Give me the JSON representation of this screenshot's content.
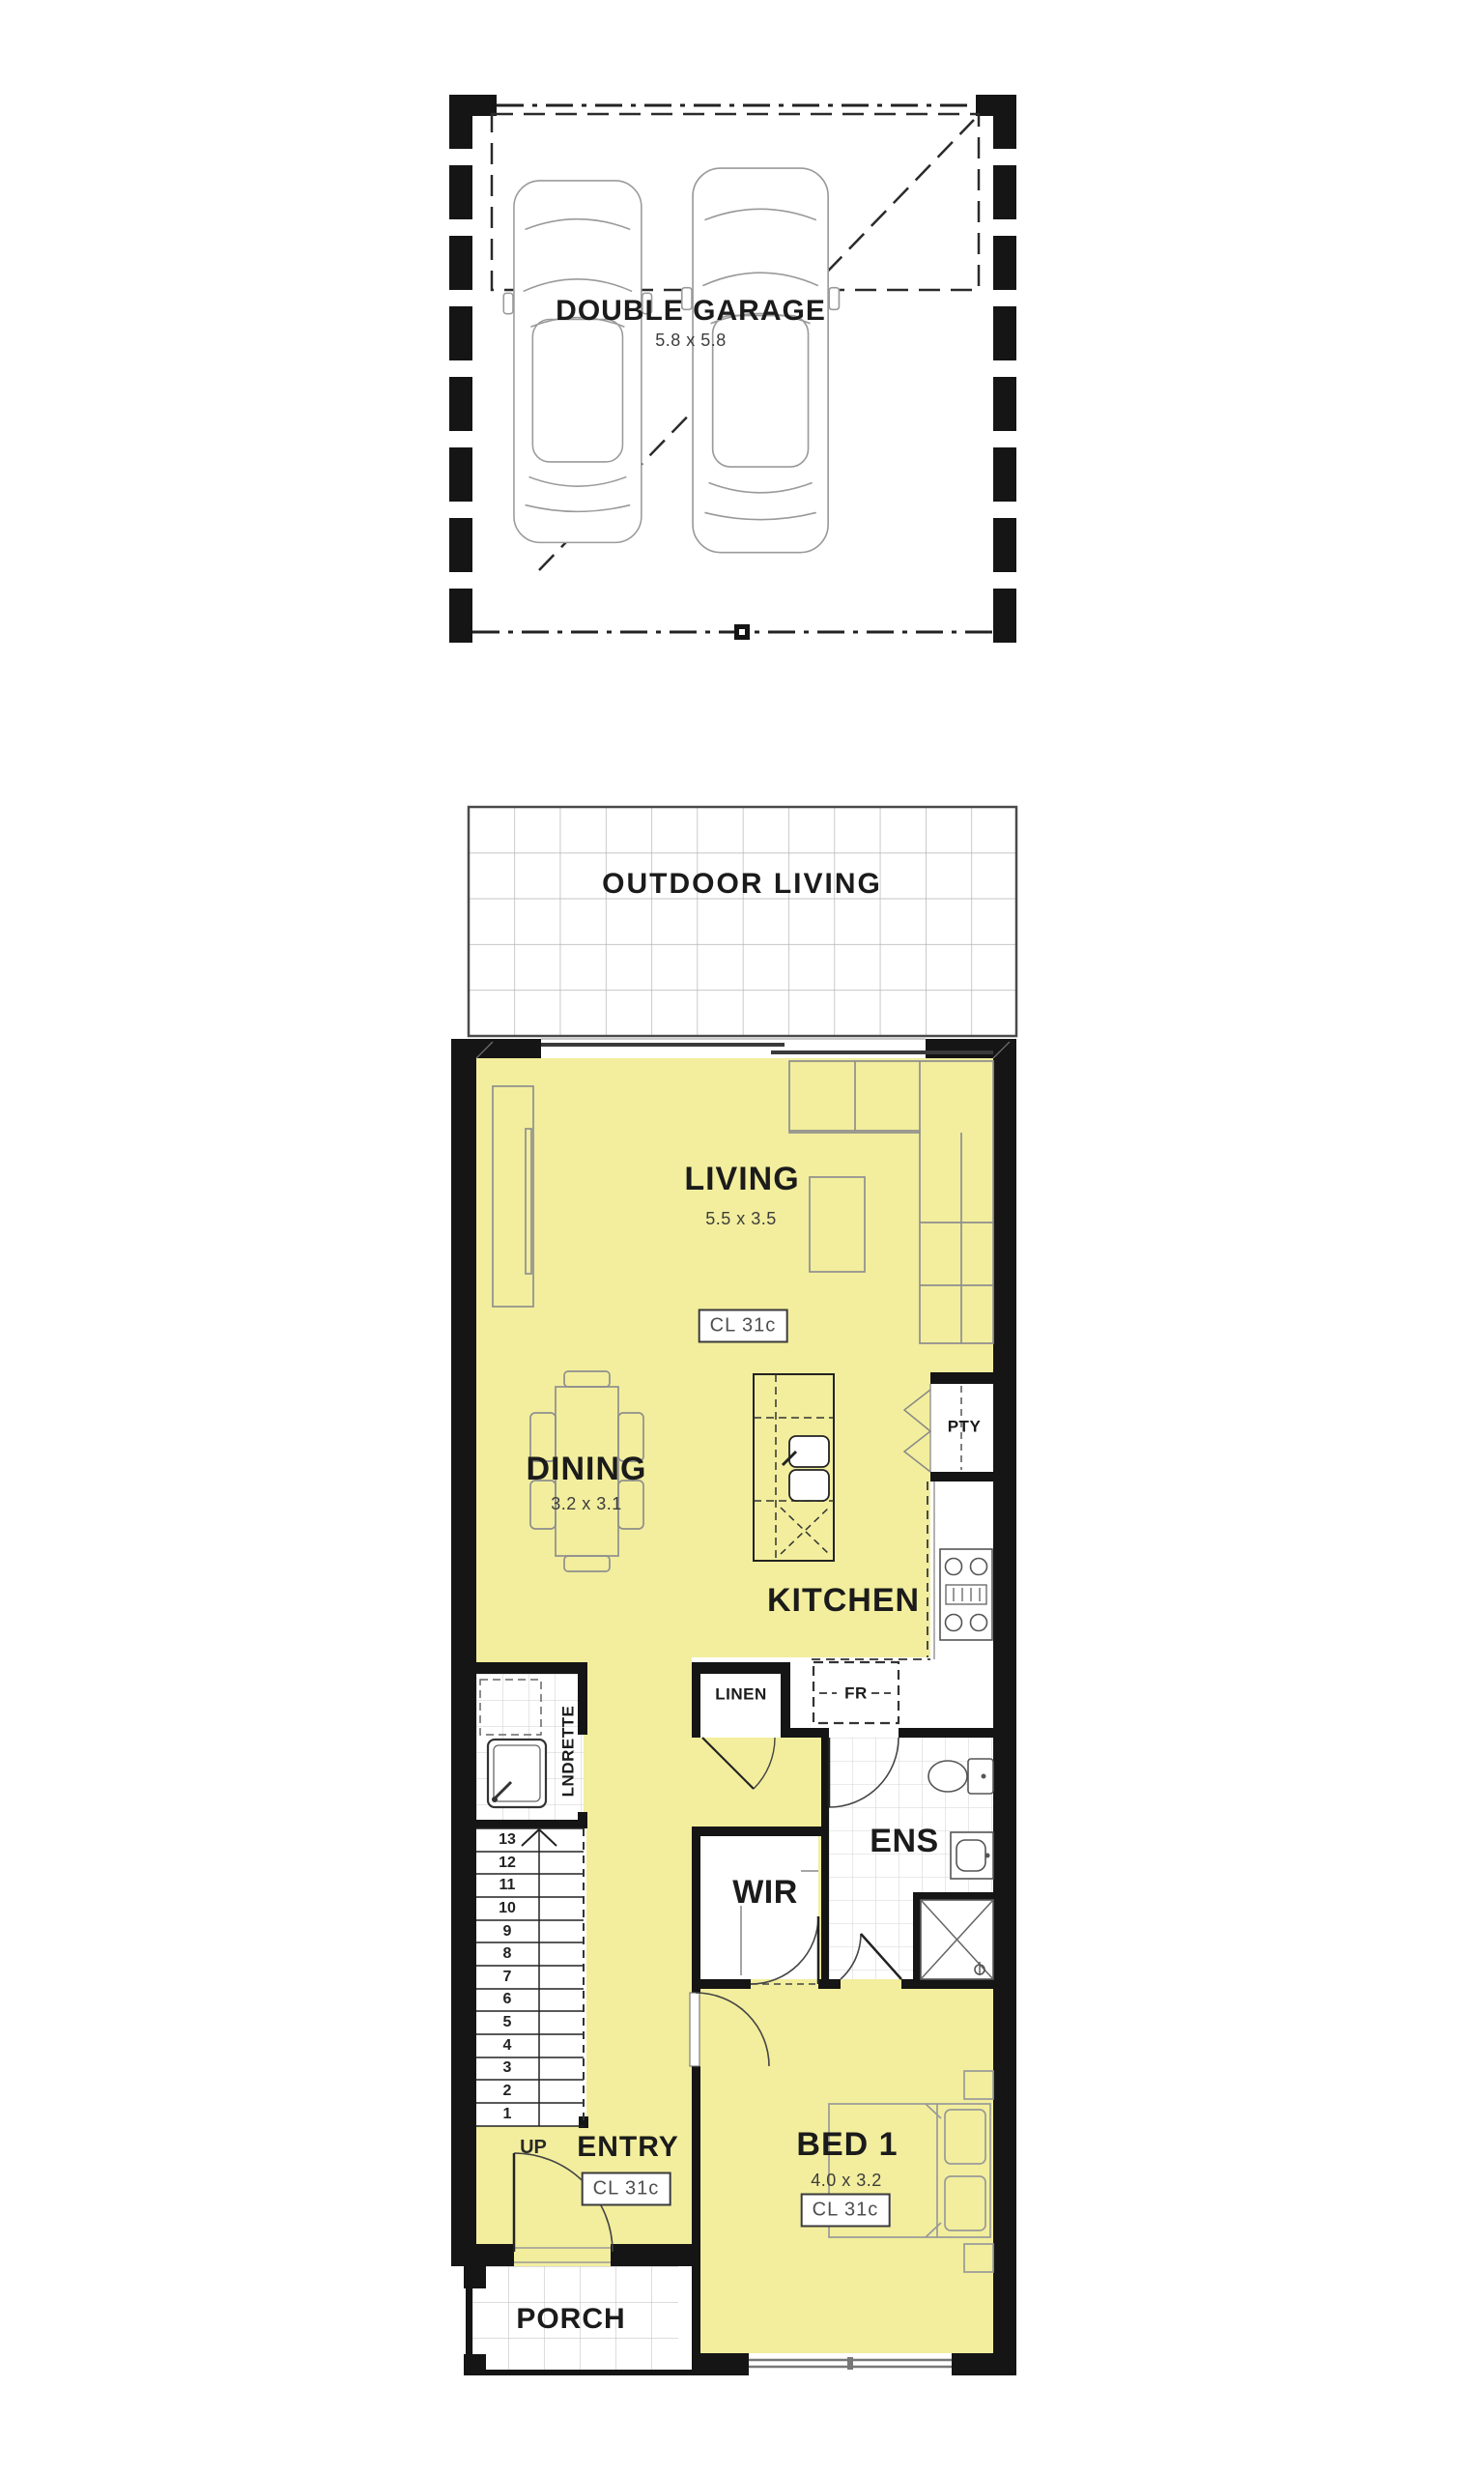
{
  "colors": {
    "floor_fill": "#F2EE9D",
    "wall": "#151515",
    "tile_line": "#c4c4c4",
    "furniture_line": "#8f8f8f"
  },
  "upper_floor": {
    "garage": {
      "label": "DOUBLE GARAGE",
      "dims": "5.8 x 5.8"
    }
  },
  "ground_floor": {
    "outdoor_living": {
      "label": "OUTDOOR LIVING"
    },
    "living": {
      "label": "LIVING",
      "dims": "5.5 x 3.5",
      "ceiling_tag": "CL 31c"
    },
    "dining": {
      "label": "DINING",
      "dims": "3.2 x 3.1"
    },
    "kitchen": {
      "label": "KITCHEN"
    },
    "pantry": {
      "label": "PTY"
    },
    "linen": {
      "label": "LINEN"
    },
    "fridge": {
      "label": "FR"
    },
    "laundry": {
      "label": "LNDRETTE"
    },
    "ensuite": {
      "label": "ENS"
    },
    "wir": {
      "label": "WIR"
    },
    "entry": {
      "label": "ENTRY",
      "up_label": "UP",
      "ceiling_tag": "CL 31c"
    },
    "bed1": {
      "label": "BED 1",
      "dims": "4.0 x 3.2",
      "ceiling_tag": "CL 31c"
    },
    "porch": {
      "label": "PORCH"
    },
    "stairs": {
      "numbers": [
        "13",
        "12",
        "11",
        "10",
        "9",
        "8",
        "7",
        "6",
        "5",
        "4",
        "3",
        "2",
        "1"
      ]
    }
  }
}
